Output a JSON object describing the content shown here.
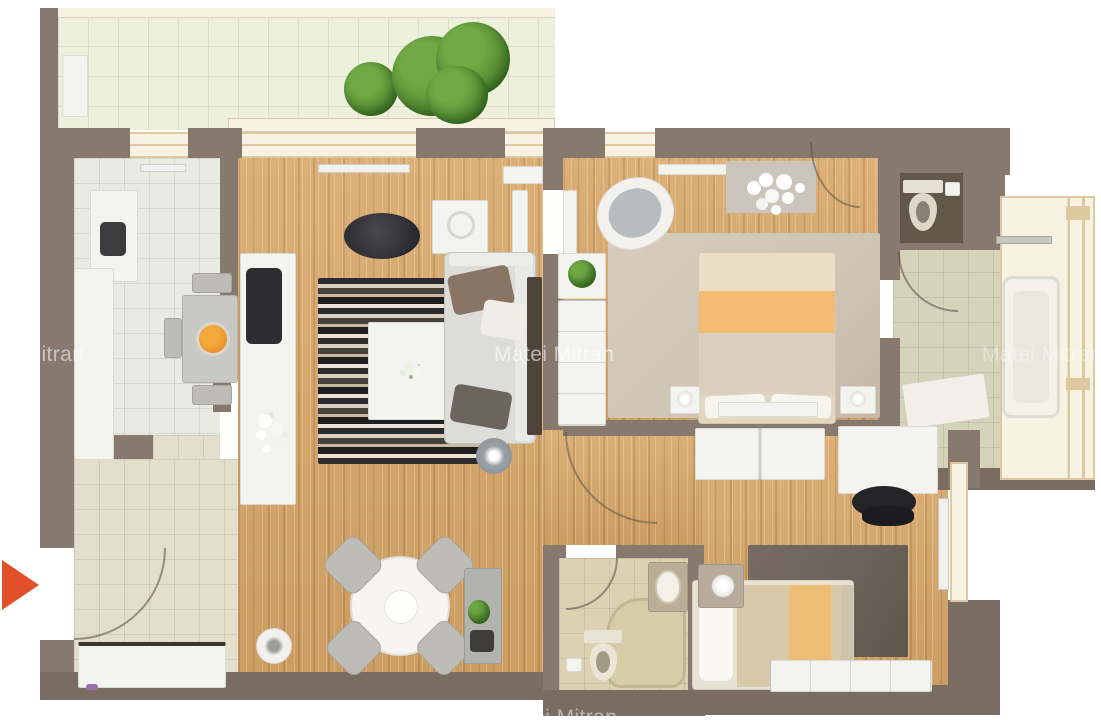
{
  "canvas": {
    "width": 1101,
    "height": 720,
    "background": "#ffffff"
  },
  "watermark": {
    "text": "Matei Mitran",
    "color": "#ffffff"
  },
  "play_arrow": {
    "color": "#e2502a"
  },
  "palette": {
    "bg": "#ffffff",
    "wall": "#87796e",
    "wallDark": "#7a6c61",
    "wood": "#d8a768",
    "kitchenTile": "#e9eae2",
    "hallTile": "#e4decd",
    "balconyTile": "#edf0db",
    "bathTile": "#d5d3ba",
    "bath2Tile": "#dbd2b2",
    "wcFloor": "#62584a",
    "white": "#f3f3f0",
    "cream": "#f7f2e2",
    "frame": "#dcc9a0",
    "midGray": "#bdbcb7",
    "sofaGray": "#dcdcd8",
    "rugBeige": "#cfc5b5",
    "rugDark": "#6c6359",
    "pillowBrown": "#8a7464",
    "pillowDark": "#6b655e",
    "tvBrown": "#4e433b",
    "black": "#2e2e30",
    "orangeBlanket": "#f3bc72",
    "bedBeige": "#e2d7c0",
    "fruitOrange": "#e8952d",
    "green": "#6faa44",
    "greenDark": "#4a7d2c",
    "lampGray": "#9aa2a8",
    "accent": "#e2502a",
    "wmColor": "#ffffff"
  }
}
